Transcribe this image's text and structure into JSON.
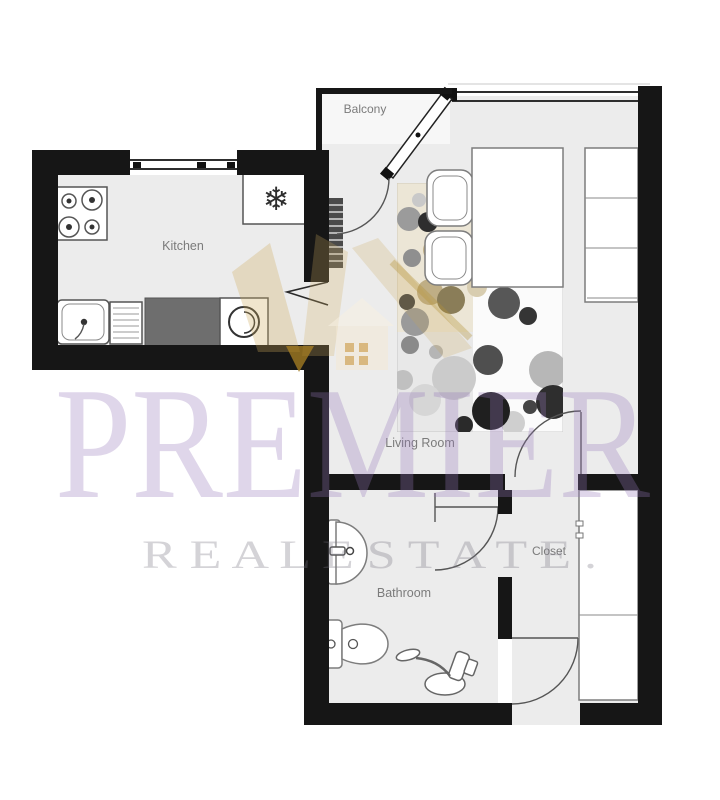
{
  "watermark": {
    "brand": "PREMIER",
    "tagline": "R E A L   E S T A T E .",
    "brand_color": "#e5e0ee",
    "wall_tint": "#2d2437",
    "crown_gold": "#c9a227"
  },
  "rooms": {
    "kitchen": {
      "label": "Kitchen"
    },
    "balcony": {
      "label": "Balcony"
    },
    "living": {
      "label": "Living Room"
    },
    "bathroom": {
      "label": "Bathroom"
    },
    "closet": {
      "label": "Closet"
    }
  },
  "icons": {
    "snowflake": "❄"
  },
  "colors": {
    "wall": "#161616",
    "floor": "#ececec",
    "counter": "#6e6e6e",
    "fixture_stroke": "#7d7d7d"
  },
  "rug": {
    "tiles": {
      "beige": "rgba(216,199,160,0.40)",
      "gray": "rgba(182,182,182,0.28)"
    },
    "dots": [
      [
        409,
        219,
        12,
        "#9b9b9b"
      ],
      [
        419,
        200,
        7,
        "#c9c9c9"
      ],
      [
        428,
        222,
        10,
        "#2e2e2e"
      ],
      [
        434,
        250,
        11,
        "#c2b189"
      ],
      [
        412,
        258,
        9,
        "#8f8f8f"
      ],
      [
        430,
        292,
        13,
        "#bfae85"
      ],
      [
        451,
        300,
        14,
        "#8a7d58"
      ],
      [
        407,
        302,
        8,
        "#444444"
      ],
      [
        415,
        322,
        14,
        "#9a9a9a"
      ],
      [
        410,
        345,
        9,
        "#8a8a8a"
      ],
      [
        436,
        352,
        7,
        "#b5b5b5"
      ],
      [
        454,
        378,
        22,
        "#cbcbcb"
      ],
      [
        488,
        360,
        15,
        "#4f4f4f"
      ],
      [
        504,
        303,
        16,
        "#575757"
      ],
      [
        528,
        316,
        9,
        "#353535"
      ],
      [
        548,
        370,
        19,
        "#b7b7b7"
      ],
      [
        553,
        402,
        17,
        "#2e2e2e"
      ],
      [
        530,
        407,
        7,
        "#454545"
      ],
      [
        513,
        423,
        12,
        "#cfcfcf"
      ],
      [
        491,
        411,
        19,
        "#1f1f1f"
      ],
      [
        464,
        425,
        9,
        "#2a2a2a"
      ],
      [
        425,
        400,
        16,
        "#d6d6d6"
      ],
      [
        403,
        380,
        10,
        "#c0c0c0"
      ],
      [
        477,
        287,
        10,
        "#d8cdb0"
      ]
    ]
  }
}
